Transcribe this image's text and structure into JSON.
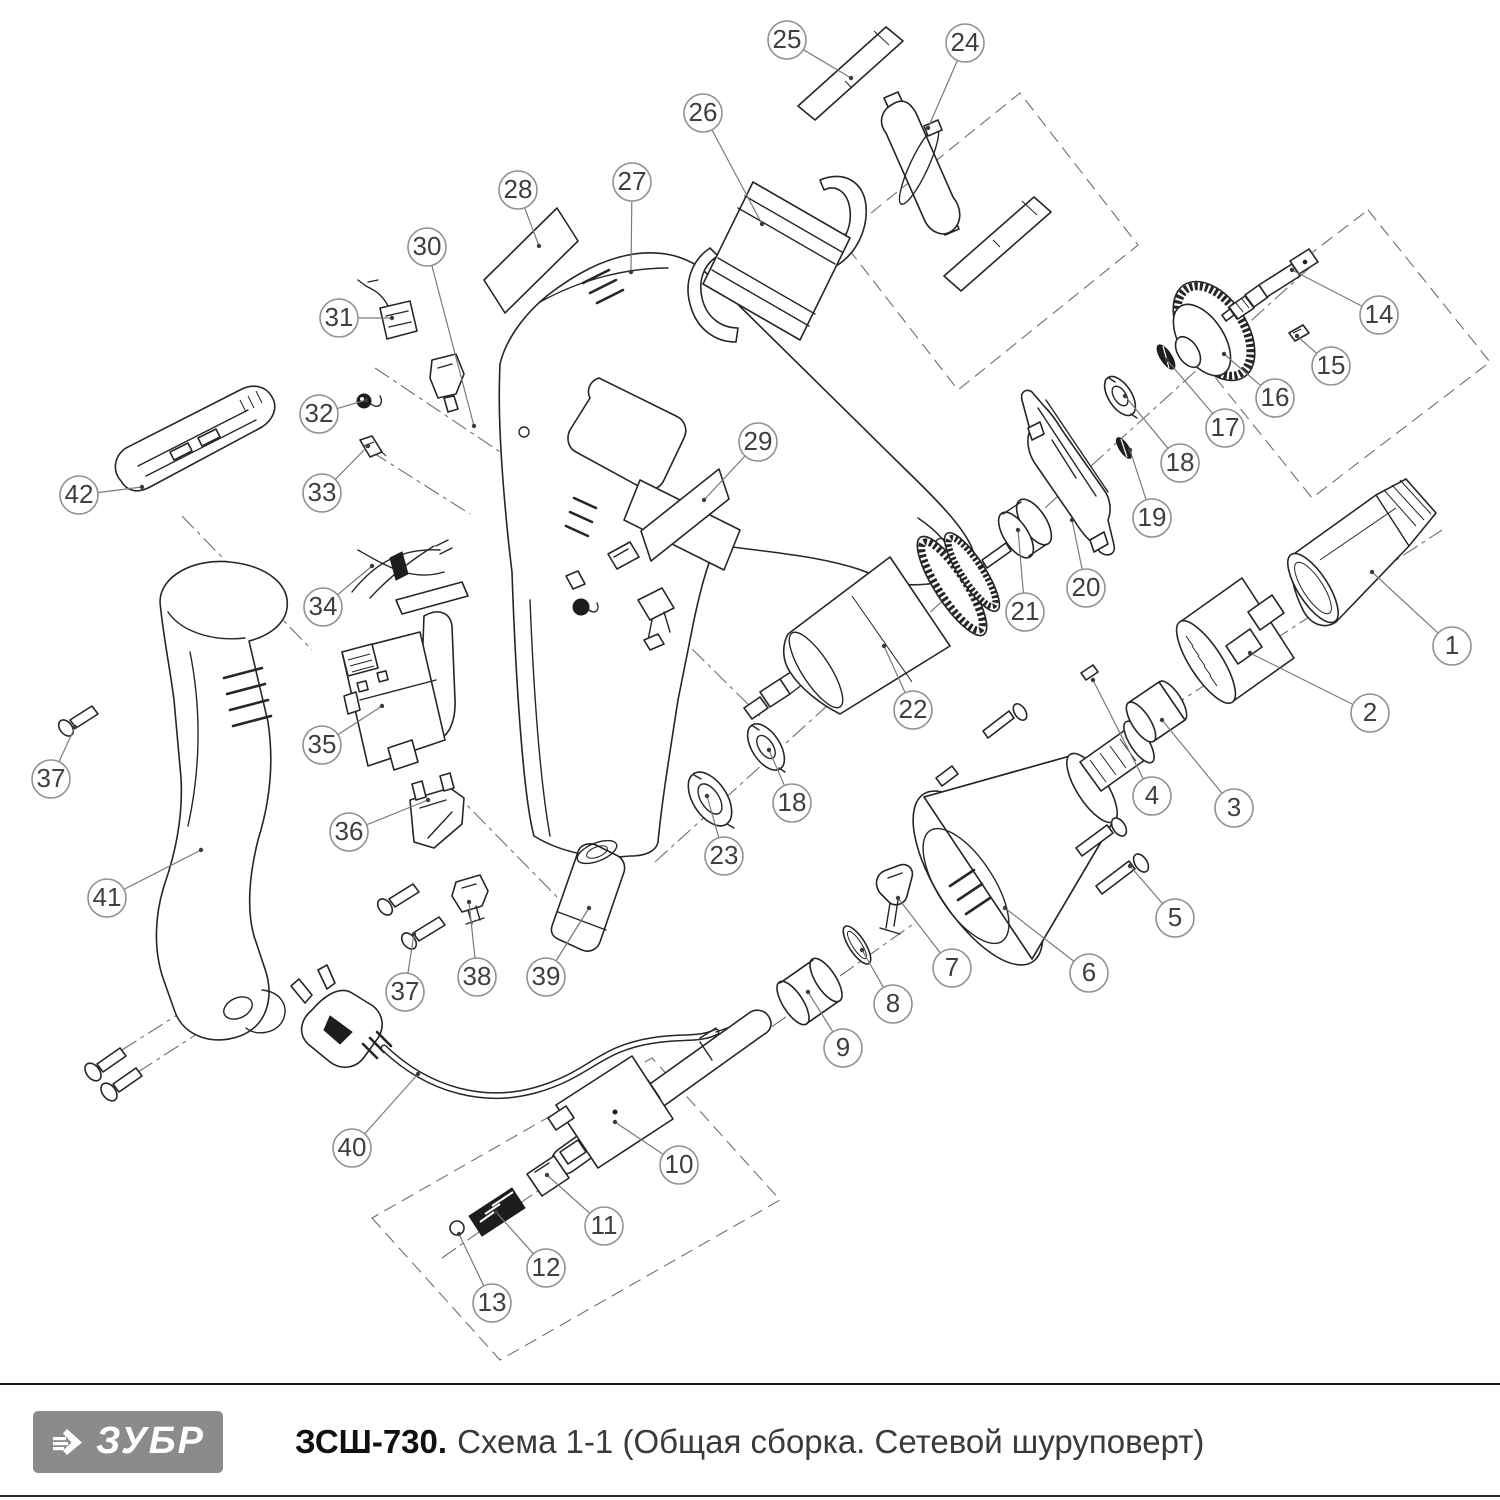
{
  "title_bar": {
    "brand": "ЗУБР",
    "model": "ЗСШ-730.",
    "caption": "Схема 1-1 (Общая сборка. Сетевой шуруповерт)",
    "logo_bg": "#8b8b8d",
    "rule_color": "#191919"
  },
  "diagram": {
    "background": "#ffffff",
    "line_color": "#262626",
    "balloon": {
      "radius": 19,
      "stroke": "#8f9193",
      "fill": "#ffffff",
      "text_color": "#3f3f3f",
      "font_size": 26,
      "leader_color": "#7a7a7a",
      "dot_color": "#3c3c3c"
    },
    "callouts": [
      {
        "n": "1",
        "cx": 1452,
        "cy": 646,
        "tx": 1372,
        "ty": 572
      },
      {
        "n": "2",
        "cx": 1370,
        "cy": 713,
        "tx": 1250,
        "ty": 653
      },
      {
        "n": "3",
        "cx": 1234,
        "cy": 808,
        "tx": 1162,
        "ty": 720
      },
      {
        "n": "4",
        "cx": 1152,
        "cy": 796,
        "tx": 1093,
        "ty": 680
      },
      {
        "n": "5",
        "cx": 1175,
        "cy": 918,
        "tx": 1130,
        "ty": 866
      },
      {
        "n": "6",
        "cx": 1089,
        "cy": 973,
        "tx": 1005,
        "ty": 908
      },
      {
        "n": "7",
        "cx": 952,
        "cy": 968,
        "tx": 898,
        "ty": 898
      },
      {
        "n": "8",
        "cx": 893,
        "cy": 1004,
        "tx": 862,
        "ty": 950
      },
      {
        "n": "9",
        "cx": 843,
        "cy": 1048,
        "tx": 808,
        "ty": 992
      },
      {
        "n": "10",
        "cx": 679,
        "cy": 1165,
        "tx": 615,
        "ty": 1122
      },
      {
        "n": "11",
        "cx": 604,
        "cy": 1226,
        "tx": 547,
        "ty": 1175
      },
      {
        "n": "12",
        "cx": 546,
        "cy": 1268,
        "tx": 496,
        "ty": 1212
      },
      {
        "n": "13",
        "cx": 492,
        "cy": 1303,
        "tx": 459,
        "ty": 1234
      },
      {
        "n": "14",
        "cx": 1379,
        "cy": 315,
        "tx": 1292,
        "ty": 270
      },
      {
        "n": "15",
        "cx": 1331,
        "cy": 366,
        "tx": 1297,
        "ty": 336
      },
      {
        "n": "16",
        "cx": 1275,
        "cy": 398,
        "tx": 1224,
        "ty": 354
      },
      {
        "n": "17",
        "cx": 1225,
        "cy": 428,
        "tx": 1167,
        "ty": 360
      },
      {
        "n": "18",
        "cx": 1180,
        "cy": 463,
        "tx": 1125,
        "ty": 396
      },
      {
        "n": "19",
        "cx": 1152,
        "cy": 518,
        "tx": 1130,
        "ty": 450
      },
      {
        "n": "20",
        "cx": 1086,
        "cy": 588,
        "tx": 1072,
        "ty": 520
      },
      {
        "n": "21",
        "cx": 1025,
        "cy": 612,
        "tx": 1018,
        "ty": 530
      },
      {
        "n": "22",
        "cx": 913,
        "cy": 710,
        "tx": 884,
        "ty": 646
      },
      {
        "n": "23",
        "cx": 724,
        "cy": 856,
        "tx": 707,
        "ty": 796
      },
      {
        "n": "18",
        "cx": 792,
        "cy": 803,
        "tx": 769,
        "ty": 750
      },
      {
        "n": "24",
        "cx": 965,
        "cy": 43,
        "tx": 928,
        "ty": 128
      },
      {
        "n": "25",
        "cx": 787,
        "cy": 40,
        "tx": 851,
        "ty": 78
      },
      {
        "n": "26",
        "cx": 703,
        "cy": 113,
        "tx": 762,
        "ty": 224
      },
      {
        "n": "27",
        "cx": 632,
        "cy": 182,
        "tx": 631,
        "ty": 272
      },
      {
        "n": "28",
        "cx": 518,
        "cy": 190,
        "tx": 539,
        "ty": 246
      },
      {
        "n": "29",
        "cx": 758,
        "cy": 442,
        "tx": 704,
        "ty": 500
      },
      {
        "n": "30",
        "cx": 427,
        "cy": 247,
        "tx": 474,
        "ty": 426
      },
      {
        "n": "31",
        "cx": 339,
        "cy": 318,
        "tx": 392,
        "ty": 318
      },
      {
        "n": "32",
        "cx": 319,
        "cy": 414,
        "tx": 366,
        "ty": 400
      },
      {
        "n": "33",
        "cx": 322,
        "cy": 493,
        "tx": 368,
        "ty": 446
      },
      {
        "n": "34",
        "cx": 323,
        "cy": 607,
        "tx": 372,
        "ty": 566
      },
      {
        "n": "35",
        "cx": 322,
        "cy": 745,
        "tx": 382,
        "ty": 706
      },
      {
        "n": "36",
        "cx": 349,
        "cy": 832,
        "tx": 428,
        "ty": 800
      },
      {
        "n": "37",
        "cx": 51,
        "cy": 779,
        "tx": 75,
        "ty": 727
      },
      {
        "n": "38",
        "cx": 477,
        "cy": 977,
        "tx": 469,
        "ty": 902
      },
      {
        "n": "39",
        "cx": 546,
        "cy": 977,
        "tx": 589,
        "ty": 908
      },
      {
        "n": "37",
        "cx": 405,
        "cy": 992,
        "tx": 414,
        "ty": 934
      },
      {
        "n": "40",
        "cx": 352,
        "cy": 1148,
        "tx": 418,
        "ty": 1074
      },
      {
        "n": "41",
        "cx": 107,
        "cy": 898,
        "tx": 201,
        "ty": 850
      },
      {
        "n": "42",
        "cx": 79,
        "cy": 495,
        "tx": 142,
        "ty": 487
      }
    ]
  }
}
